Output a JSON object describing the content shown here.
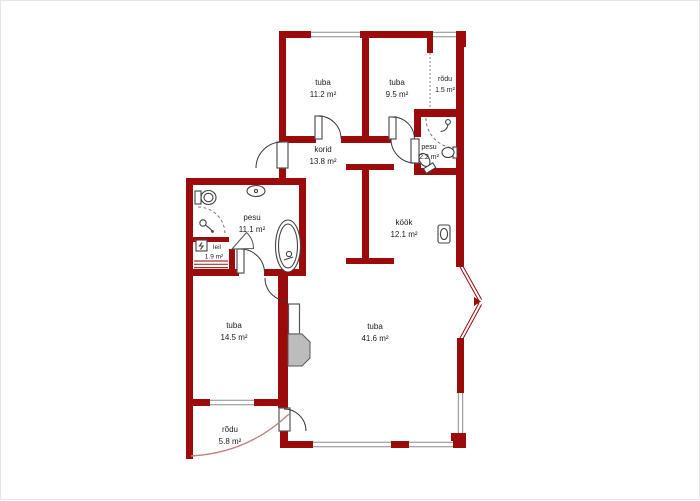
{
  "colors": {
    "wall": "#9b0b0b",
    "window_line": "#8a8a8a",
    "door_line": "#3a3a3a",
    "fixture_line": "#444444",
    "fireplace_fill": "#bcbcbc",
    "balcony_edge": "#c08484",
    "label_text": "#1c1c1c",
    "background": "#ffffff"
  },
  "rooms": [
    {
      "id": "tuba-1",
      "name": "tuba",
      "area": "11.2 m²"
    },
    {
      "id": "tuba-2",
      "name": "tuba",
      "area": "9.5 m²"
    },
    {
      "id": "rodu-1",
      "name": "rõdu",
      "area": "1.5 m²"
    },
    {
      "id": "korid",
      "name": "korid",
      "area": "13.8 m²"
    },
    {
      "id": "pesu-1",
      "name": "pesu",
      "area": "2.2 m²"
    },
    {
      "id": "kook",
      "name": "köök",
      "area": "12.1 m²"
    },
    {
      "id": "pesu-2",
      "name": "pesu",
      "area": "11.1 m²"
    },
    {
      "id": "leil",
      "name": "leil",
      "area": "1.9 m²"
    },
    {
      "id": "tuba-3",
      "name": "tuba",
      "area": "14.5 m²"
    },
    {
      "id": "tuba-4",
      "name": "tuba",
      "area": "41.6 m²"
    },
    {
      "id": "rodu-2",
      "name": "rõdu",
      "area": "5.8 m²"
    }
  ],
  "fixtures": [
    {
      "room": "pesu 11.1 m²",
      "items": [
        "toilet",
        "sink",
        "shower-mixer",
        "bathtub"
      ]
    },
    {
      "room": "pesu 2.2 m²",
      "items": [
        "shower-head",
        "sink",
        "toilet"
      ]
    },
    {
      "room": "köök 12.1 m²",
      "items": [
        "kitchen-sink"
      ]
    },
    {
      "room": "leil 1.9 m²",
      "items": [
        "sauna-stove",
        "sauna-bench"
      ]
    },
    {
      "room": "tuba 41.6 m²",
      "items": [
        "fireplace"
      ]
    }
  ]
}
